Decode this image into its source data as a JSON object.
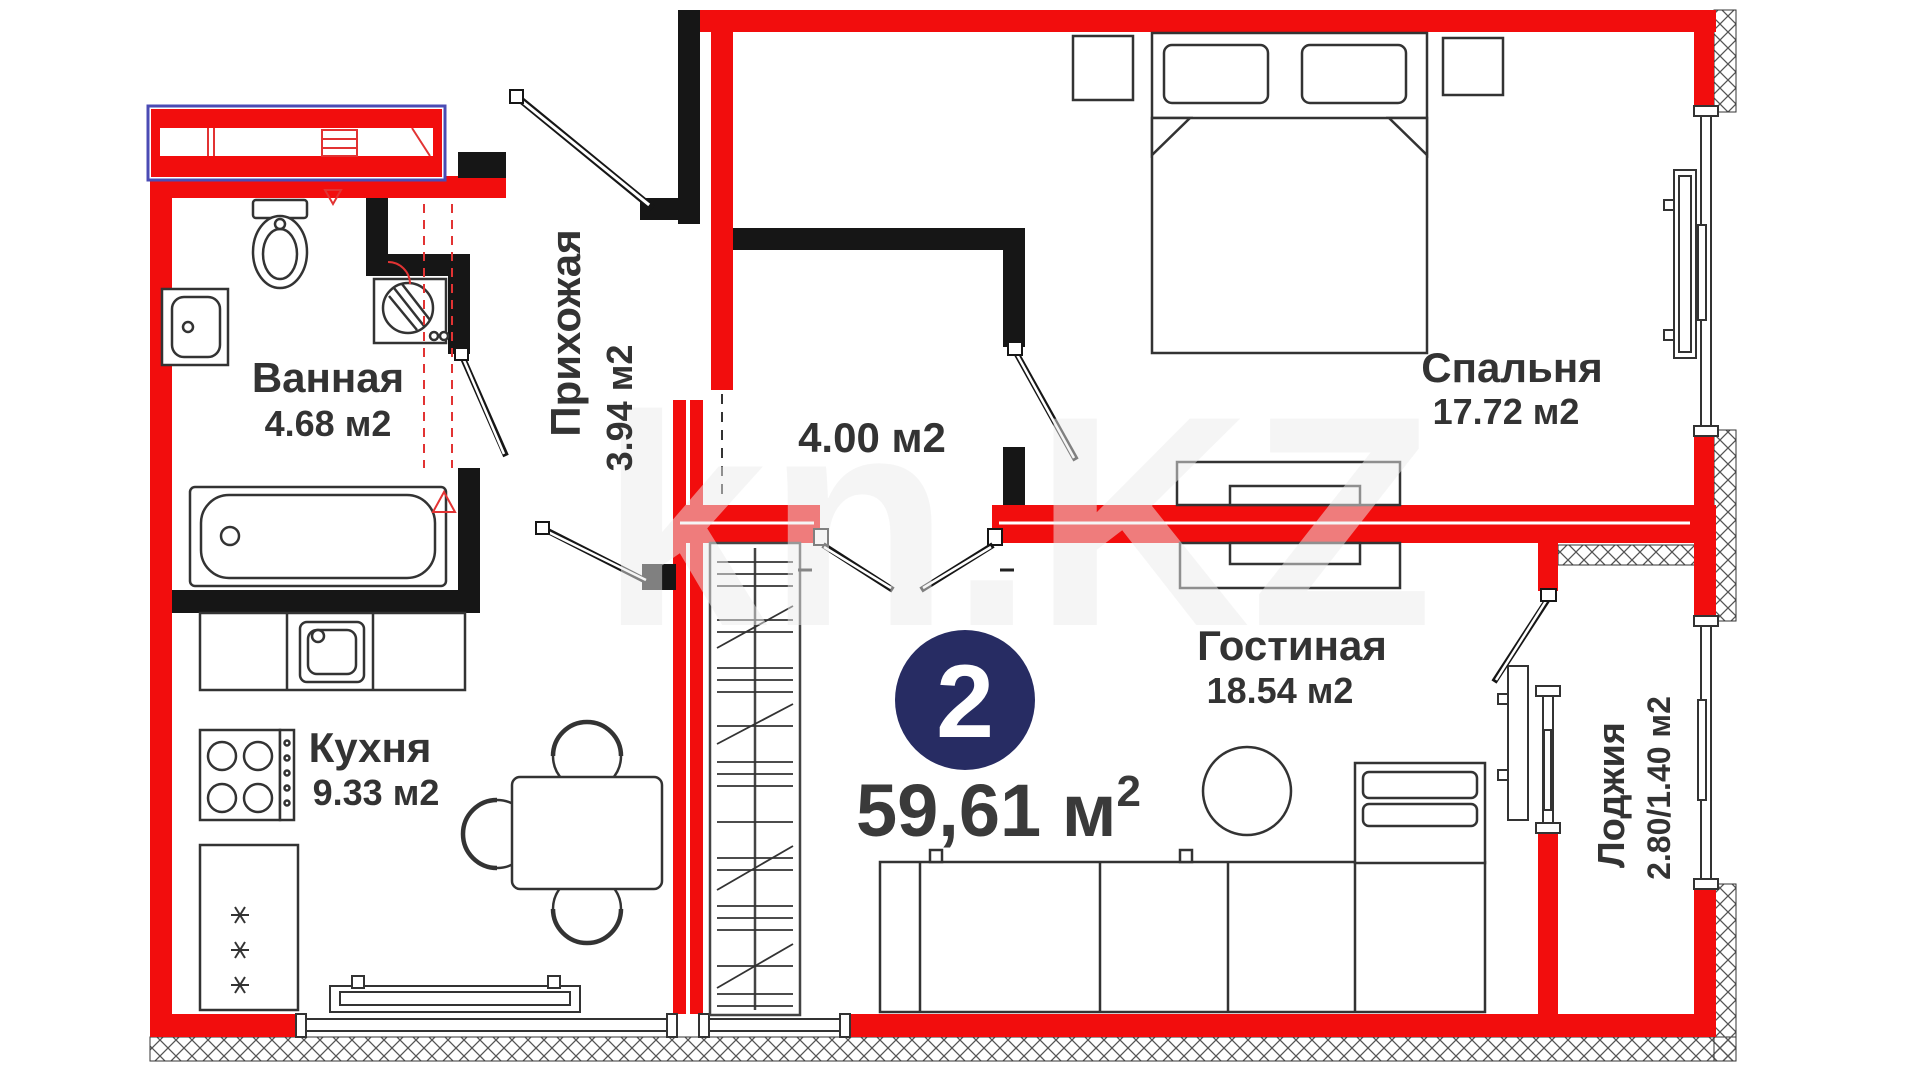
{
  "watermark": "kn.KZ",
  "badge": {
    "number": "2"
  },
  "total": {
    "value": "59,61 ",
    "unit": "м",
    "sup": "2"
  },
  "rooms": {
    "bathroom": {
      "name": "Ванная",
      "area": "4.68 м2"
    },
    "hallway": {
      "name": "Прихожая",
      "area": "3.94 м2"
    },
    "hall": {
      "area": "4.00 м2"
    },
    "bedroom": {
      "name": "Спальня",
      "area": "17.72 м2"
    },
    "kitchen": {
      "name": "Кухня",
      "area": "9.33 м2"
    },
    "living": {
      "name": "Гостиная",
      "area": "18.54 м2"
    },
    "loggia": {
      "name": "Лоджия",
      "area": "2.80/1.40 м2"
    }
  },
  "colors": {
    "wall_red": "#f20d0d",
    "partition_black": "#161616",
    "badge_navy": "#272c63",
    "vent_outline_blue": "#4b4bb4",
    "plumbing_dashed_red": "#e23333",
    "label_text": "#333333"
  }
}
